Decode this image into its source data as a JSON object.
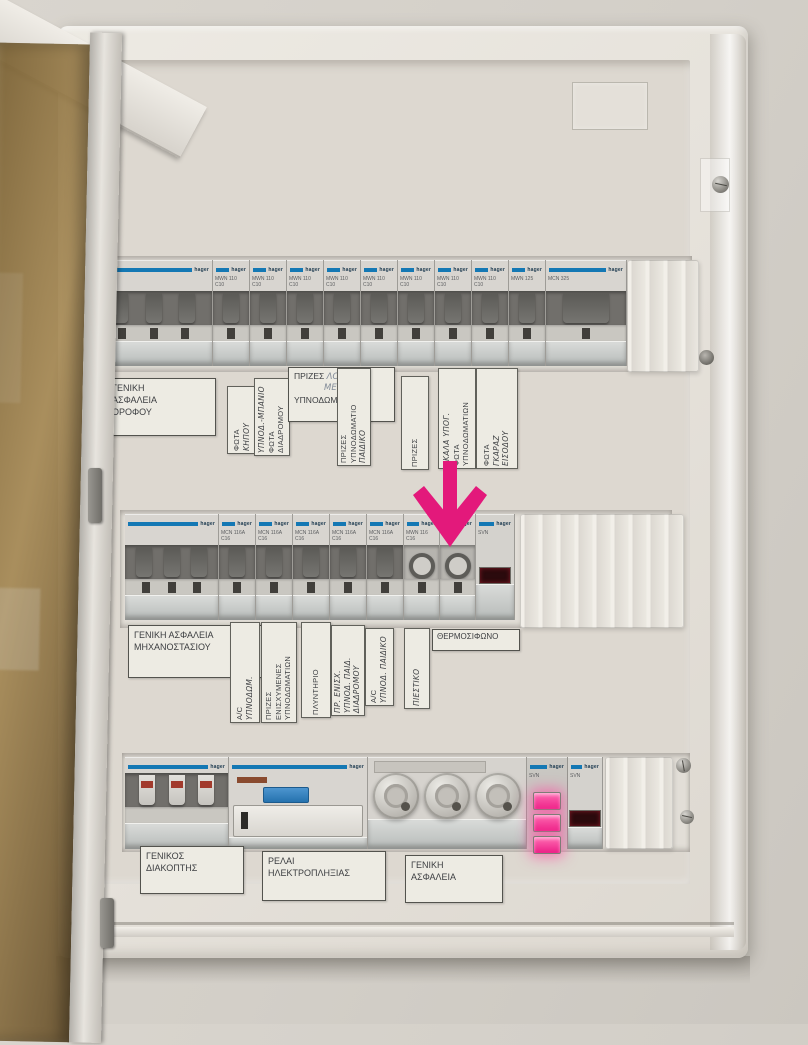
{
  "panel": {
    "brand": "hager",
    "rows": {
      "top": [
        {
          "type": "main",
          "code": "",
          "rating": ""
        },
        {
          "type": "single",
          "code": "MWN 110",
          "rating": "C10"
        },
        {
          "type": "single",
          "code": "MWN 110",
          "rating": "C10"
        },
        {
          "type": "single",
          "code": "MWN 110",
          "rating": "C10"
        },
        {
          "type": "single",
          "code": "MWN 110",
          "rating": "C10"
        },
        {
          "type": "single",
          "code": "MWN 110",
          "rating": "C10"
        },
        {
          "type": "single",
          "code": "MWN 110",
          "rating": "C10"
        },
        {
          "type": "single",
          "code": "MWN 110",
          "rating": "C10"
        },
        {
          "type": "single",
          "code": "MWN 110",
          "rating": "C10"
        },
        {
          "type": "single",
          "code": "MWN 125",
          "rating": ""
        },
        {
          "type": "double",
          "code": "MCN 325",
          "rating": ""
        },
        {
          "type": "filler"
        }
      ],
      "middle": [
        {
          "type": "main",
          "code": "",
          "rating": ""
        },
        {
          "type": "single",
          "code": "MCN 116A",
          "rating": "C16"
        },
        {
          "type": "single",
          "code": "MCN 116A",
          "rating": "C16"
        },
        {
          "type": "single",
          "code": "MCN 116A",
          "rating": "C16"
        },
        {
          "type": "single",
          "code": "MCN 116A",
          "rating": "C16"
        },
        {
          "type": "single",
          "code": "MCN 116A",
          "rating": "C16"
        },
        {
          "type": "round",
          "code": "MWN 116",
          "rating": "C16"
        },
        {
          "type": "round",
          "code": "",
          "rating": "",
          "target": true
        },
        {
          "type": "pilotdark",
          "code": "SVN"
        },
        {
          "type": "fillerwide"
        }
      ],
      "bottom": [
        {
          "type": "switch3",
          "code": "",
          "rating": ""
        },
        {
          "type": "rcd",
          "code": "",
          "rating": ""
        },
        {
          "type": "fuses"
        },
        {
          "type": "pilot3",
          "code": "SVN"
        },
        {
          "type": "pilotdark",
          "code": "SVN"
        },
        {
          "type": "filler"
        }
      ]
    }
  },
  "labels": {
    "t0": {
      "a": "ΓΕΝΙΚΗ",
      "b": "ΑΣΦΑΛΕΙΑ",
      "c": "ΟΡΟΦΟΥ"
    },
    "t1": {
      "a": "ΦΩΤΑ",
      "b": "ΚΗΠΟΥ"
    },
    "t2": {
      "a": "ΥΠΝΟΔ.-ΜΠΑΝΙΟ",
      "b": "ΦΩΤΑ",
      "c": "ΔΙΑΔΡΟΜΟΥ"
    },
    "t3": {
      "a": "ΠΡΙΖΕΣ",
      "b": "ΛΟΥΤΡΟΥ",
      "c": "ΜΕΓΑΛΑ",
      "d": "ΥΠΝΟΔΩΜΑΤΙΩΝ"
    },
    "t4": {
      "a": "ΠΡΙΖΕΣ",
      "b": "ΥΠΝΟΔΩΜΑΤΙΟ",
      "c": "ΠΑΙΔΙΚΟ"
    },
    "t5": {
      "a": "ΠΡΙΖΕΣ"
    },
    "t6": {
      "a": "ΣΚΑΛΑ ΥΠΟΓ.",
      "b": "ΦΩΤΑ",
      "c": "ΥΠΝΟΔΩΜΑΤΙΩΝ"
    },
    "t7": {
      "a": "ΦΩΤΑ",
      "b": "ΓΚΑΡΑΖ",
      "c": "ΕΙΣΟΔΟΥ"
    },
    "m0": {
      "a": "ΓΕΝΙΚΗ ΑΣΦΑΛΕΙΑ",
      "b": "ΜΗΧΑΝΟΣΤΑΣΙΟΥ"
    },
    "m1": {
      "a": "A/C",
      "b": "ΥΠΝΟΔΩΜ."
    },
    "m2": {
      "a": "ΠΡΙΖΕΣ",
      "b": "ΕΝΙΣΧΥΜΕΝΕΣ",
      "c": "ΥΠΝΟΔΩΜΑΤΙΩΝ"
    },
    "m3": {
      "a": "ΠΛΥΝΤΗΡΙΟ"
    },
    "m4": {
      "a": "ΠΡ. ΕΝΙΣΧ.",
      "b": "ΥΠΝΟΔ. ΠΑΙΔ.",
      "c": "ΔΙΑΔΡΟΜΟΥ"
    },
    "m5": {
      "a": "A/C",
      "b": "ΥΠΝΟΔ. ΠΑΙΔΙΚΟ"
    },
    "m6": {
      "a": "ΠΙΕΣΤΙΚΟ"
    },
    "m7": {
      "a": "ΘΕΡΜΟΣΙΦΩΝΟ"
    },
    "b0": {
      "a": "ΓΕΝΙΚΟΣ",
      "b": "ΔΙΑΚΟΠΤΗΣ"
    },
    "b1": {
      "a": "ΡΕΛΑΙ",
      "b": "ΗΛΕΚΤΡΟΠΛΗΞΙΑΣ"
    },
    "b2": {
      "a": "ΓΕΝΙΚΗ",
      "b": "ΑΣΦΑΛΕΙΑ"
    }
  },
  "annotation": {
    "shape": "down-arrow",
    "color": "#E3197B"
  }
}
